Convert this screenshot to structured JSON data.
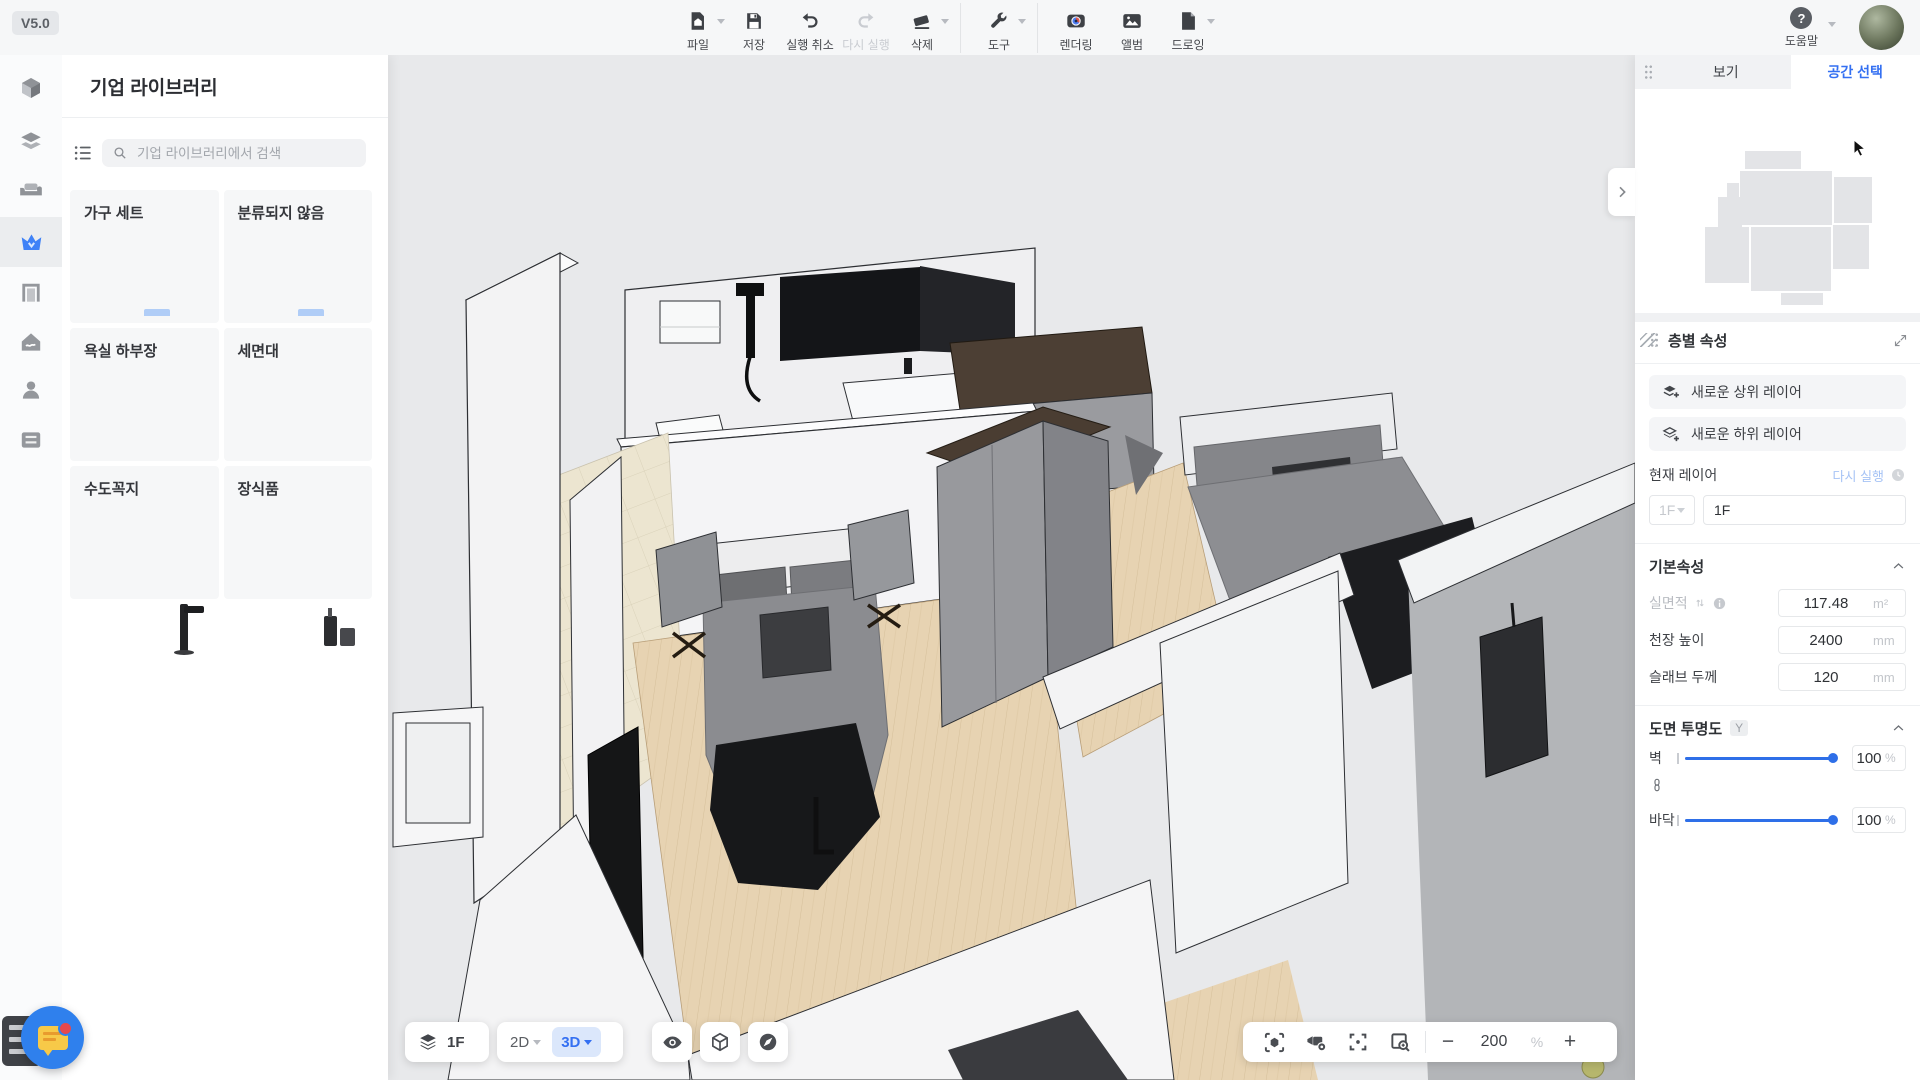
{
  "app": {
    "version": "V5.0"
  },
  "topbar": {
    "groups": [
      {
        "items": [
          {
            "label": "파일",
            "icon": "file-home-icon",
            "dropdown": true
          },
          {
            "label": "저장",
            "icon": "save-icon",
            "dropdown": false
          },
          {
            "label": "실행 취소",
            "icon": "undo-icon",
            "dropdown": false
          },
          {
            "label": "다시 실행",
            "icon": "redo-icon",
            "disabled": true
          },
          {
            "label": "삭제",
            "icon": "eraser-icon",
            "dropdown": true
          }
        ]
      },
      {
        "items": [
          {
            "label": "도구",
            "icon": "wrench-icon",
            "dropdown": true
          }
        ]
      },
      {
        "items": [
          {
            "label": "렌더링",
            "icon": "render-camera-icon"
          },
          {
            "label": "앨범",
            "icon": "album-icon"
          },
          {
            "label": "드로잉",
            "icon": "drawing-page-icon",
            "dropdown": true
          }
        ]
      }
    ],
    "help_label": "도움말"
  },
  "sidebar": {
    "icons": [
      "construction-cube",
      "furniture-sets",
      "soft-furnishing-sofa",
      "enterprise-library-crown",
      "doors-windows",
      "smart-home",
      "my-account",
      "storage-drawer"
    ],
    "active": "enterprise-library-crown"
  },
  "library_panel": {
    "title": "기업 라이브러리",
    "search_placeholder": "기업 라이브러리에서 검색",
    "categories": [
      {
        "name": "가구 세트",
        "thumb": "folder"
      },
      {
        "name": "분류되지 않음",
        "thumb": "folder"
      },
      {
        "name": "욕실 하부장",
        "thumb": "vanity"
      },
      {
        "name": "세면대",
        "thumb": "basin"
      },
      {
        "name": "수도꼭지",
        "thumb": "faucet"
      },
      {
        "name": "장식품",
        "thumb": "decor"
      }
    ]
  },
  "right_panel": {
    "tab_view": "보기",
    "tab_space": "공간 선택",
    "section_title": "층별 속성",
    "new_upper_layer": "새로운 상위 레이어",
    "new_lower_layer": "새로운 하위 레이어",
    "current_layer_label": "현재 레이어",
    "redo_label": "다시 실행",
    "layer_select": "1F",
    "layer_name": "1F",
    "basic": {
      "title": "기본속성",
      "area_label": "실면적",
      "area_value": "117.48",
      "area_unit": "m²",
      "ceiling_label": "천장 높이",
      "ceiling_value": "2400",
      "ceiling_unit": "mm",
      "slab_label": "슬래브 두께",
      "slab_value": "120",
      "slab_unit": "mm"
    },
    "transparency": {
      "title": "도면 투명도",
      "shortcut": "Y",
      "wall_label": "벽",
      "wall_value": "100",
      "wall_unit": "%",
      "wall_percent": 100,
      "floor_label": "바닥",
      "floor_value": "100",
      "floor_unit": "%",
      "floor_percent": 100
    }
  },
  "canvas_controls": {
    "floor": "1F",
    "mode_2d": "2D",
    "mode_3d": "3D",
    "zoom_value": "200",
    "zoom_unit": "%",
    "zoom_out": "−",
    "zoom_in": "+"
  },
  "colors": {
    "accent_blue": "#3470f2",
    "slider_blue": "#2e6fe8",
    "folder_blue": "#b7d2f8",
    "canvas_bg": "#e8e9eb",
    "wood_floor": "#e7d3b2",
    "tile_floor": "#ece5d0"
  }
}
